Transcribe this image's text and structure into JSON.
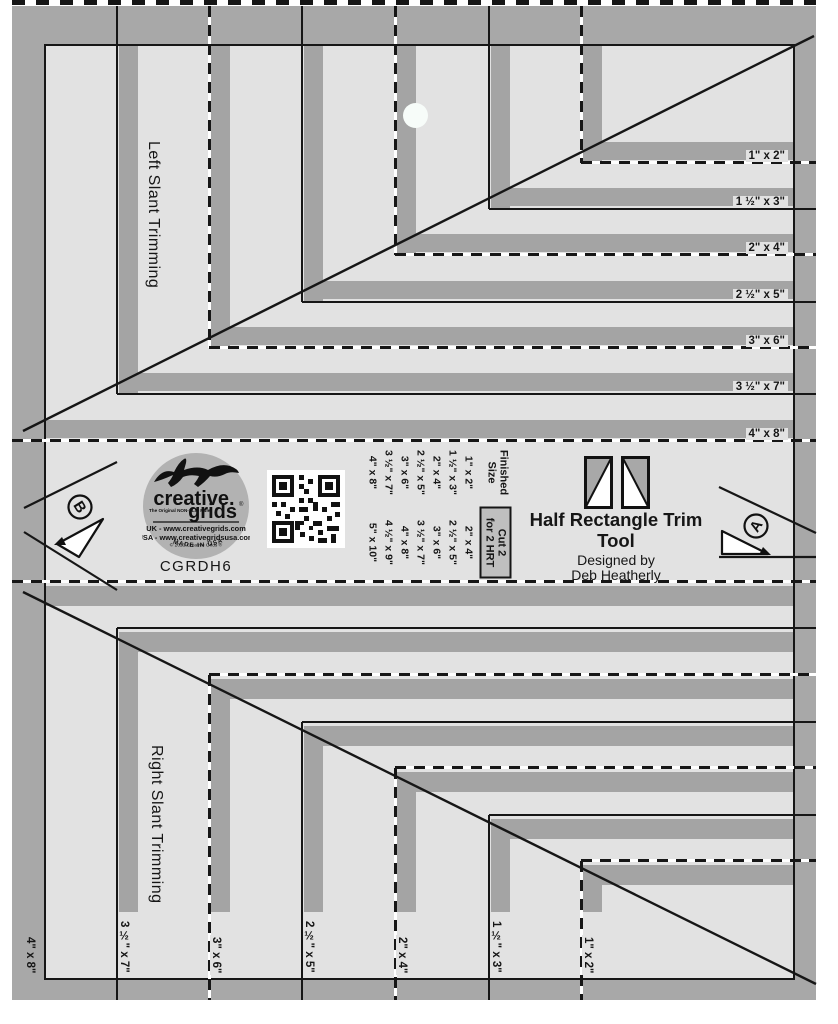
{
  "sheet": {
    "model_number": "CGRDH6",
    "title": "Half Rectangle Trim Tool",
    "byline": "Designed by",
    "designer": "Deb Heatherly",
    "top_section_label": "Left Slant Trimming",
    "bottom_section_label": "Right Slant Trimming",
    "marker_a": "A",
    "marker_b": "B"
  },
  "trim_sizes": [
    "1\" x 2\"",
    "1 ½\" x 3\"",
    "2\" x 4\"",
    "2 ½\" x 5\"",
    "3\" x 6\"",
    "3 ½\" x 7\"",
    "4\" x 8\""
  ],
  "size_table": {
    "finished_header_line1": "Finished",
    "finished_header_line2": "Size",
    "cut_header_line1": "Cut 2",
    "cut_header_line2": "for 2 HRT",
    "rows": [
      {
        "finished": "1\" x 2\"",
        "cut": "2\" x 4\""
      },
      {
        "finished": "1 ½\" x 3\"",
        "cut": "2 ½\" x 5\""
      },
      {
        "finished": "2\" x 4\"",
        "cut": "3\" x 6\""
      },
      {
        "finished": "2 ½\" x 5\"",
        "cut": "3 ½\" x 7\""
      },
      {
        "finished": "3\" x 6\"",
        "cut": "4\" x 8\""
      },
      {
        "finished": "3 ½\" x 7\"",
        "cut": "4 ½\" x 9\""
      },
      {
        "finished": "4\" x 8\"",
        "cut": "5\" x 10\""
      }
    ]
  },
  "logo": {
    "brand_line1": "creative.",
    "brand_line2": "grids",
    "registered": "®",
    "tagline": "The Original NON-SLIP Ruler",
    "uk_line": "UK - www.creativegrids.com",
    "usa_line": "USA - www.creativegridsusa.com",
    "copyright_line": "© 2023 Creative Grids ®",
    "made_in": "MADE IN USA"
  },
  "colors": {
    "frame_gray": "#a8a8a8",
    "bar_gray": "#a4a4a4",
    "interior_gray": "#e2e2e2",
    "logo_gray": "#b2b2b2",
    "line_black": "#161616"
  }
}
